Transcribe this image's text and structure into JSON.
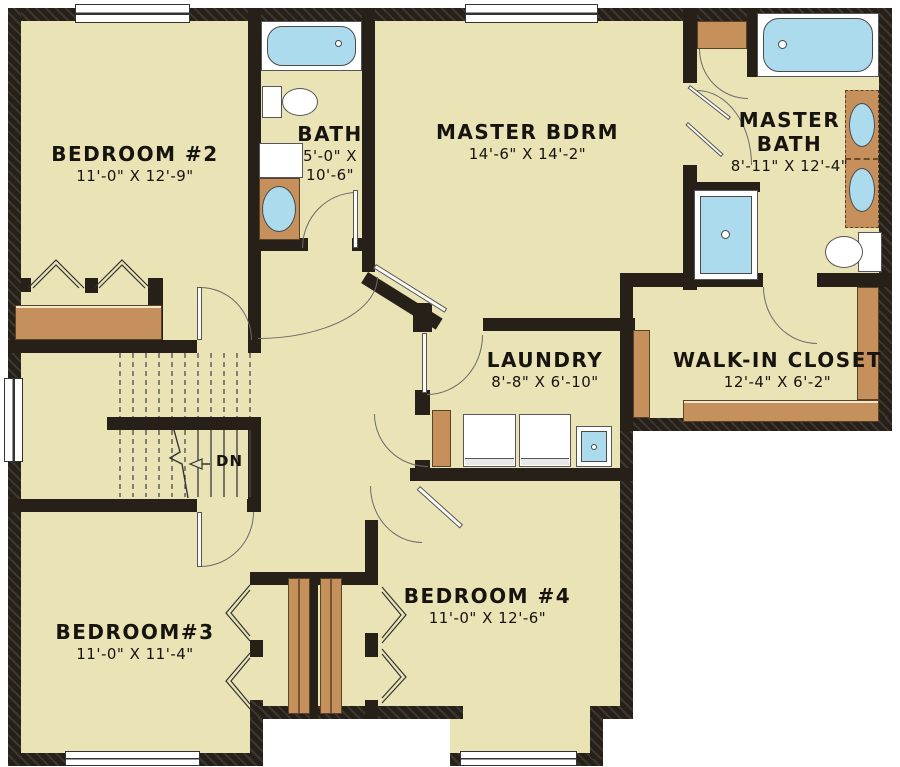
{
  "title": "Second floor plan",
  "rooms": [
    {
      "id": "bedroom2",
      "name": "BEDROOM #2",
      "dims": "11'-0\" X 12'-9\""
    },
    {
      "id": "bath",
      "name": "BATH",
      "dims_line1": "5'-0\" X",
      "dims_line2": "10'-6\""
    },
    {
      "id": "master_bdrm",
      "name": "MASTER BDRM",
      "dims": "14'-6\" X 14'-2\""
    },
    {
      "id": "master_bath",
      "name_line1": "MASTER",
      "name_line2": "BATH",
      "dims": "8'-11\" X 12'-4\""
    },
    {
      "id": "laundry",
      "name": "LAUNDRY",
      "dims": "8'-8\" X 6'-10\""
    },
    {
      "id": "walk_in_closet",
      "name": "WALK-IN CLOSET",
      "dims": "12'-4\" X 6'-2\""
    },
    {
      "id": "bedroom3",
      "name": "BEDROOM#3",
      "dims": "11'-0\" X 11'-4\""
    },
    {
      "id": "bedroom4",
      "name": "BEDROOM #4",
      "dims": "11'-0\" X 12'-6\""
    }
  ],
  "stairs": {
    "down_label": "DN"
  },
  "fixtures": [
    "bathtub",
    "toilet",
    "sink-vanity",
    "garden-tub",
    "double-vanity-sinks",
    "shower",
    "washer",
    "dryer",
    "laundry-sink",
    "closet-rod",
    "closet-shelf"
  ],
  "colors": {
    "floor": "#EAE3B6",
    "wall": "#262019",
    "wood": "#C6905C",
    "water": "#ABDBED",
    "outline": "#4a4a4a"
  }
}
